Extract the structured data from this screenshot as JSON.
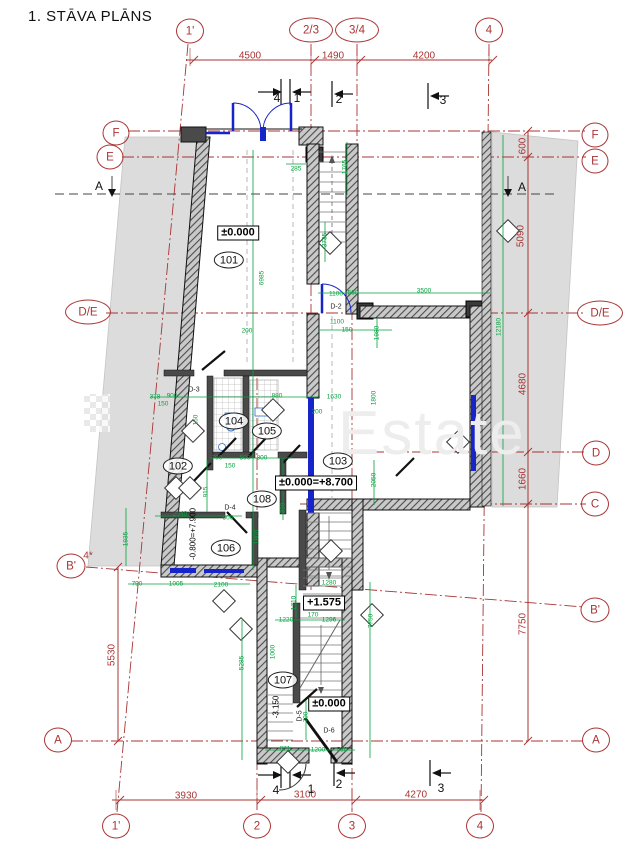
{
  "title": "1. STĀVA PLĀNS",
  "watermark": "Estate",
  "colors": {
    "axis_red": "#a93434",
    "dim_green": "#00a33c",
    "door_blue": "#1724c9",
    "wall_dark": "#4a4a4a",
    "neighbor_grey": "#dcdcdc"
  },
  "axis_markers": [
    {
      "label": "1'",
      "x": 190,
      "y": 31,
      "w": 26
    },
    {
      "label": "2/3",
      "x": 311,
      "y": 30,
      "w": 42
    },
    {
      "label": "3/4",
      "x": 357,
      "y": 30,
      "w": 42
    },
    {
      "label": "4",
      "x": 489,
      "y": 30,
      "w": 26
    },
    {
      "label": "1'",
      "x": 116,
      "y": 826,
      "w": 26
    },
    {
      "label": "2",
      "x": 257,
      "y": 826,
      "w": 26
    },
    {
      "label": "3",
      "x": 352,
      "y": 826,
      "w": 26
    },
    {
      "label": "4",
      "x": 480,
      "y": 826,
      "w": 26
    },
    {
      "label": "F",
      "x": 116,
      "y": 133,
      "w": 25
    },
    {
      "label": "E",
      "x": 110,
      "y": 157,
      "w": 25
    },
    {
      "label": "D/E",
      "x": 88,
      "y": 312,
      "w": 44
    },
    {
      "label": "B'",
      "x": 71,
      "y": 566,
      "w": 27
    },
    {
      "label": "A",
      "x": 58,
      "y": 740,
      "w": 26
    },
    {
      "label": "F",
      "x": 595,
      "y": 135,
      "w": 25
    },
    {
      "label": "E",
      "x": 595,
      "y": 161,
      "w": 25
    },
    {
      "label": "D/E",
      "x": 600,
      "y": 313,
      "w": 44
    },
    {
      "label": "D",
      "x": 596,
      "y": 453,
      "w": 26
    },
    {
      "label": "C",
      "x": 595,
      "y": 504,
      "w": 26
    },
    {
      "label": "B'",
      "x": 595,
      "y": 610,
      "w": 27
    },
    {
      "label": "A",
      "x": 596,
      "y": 740,
      "w": 26
    }
  ],
  "red_dims": [
    {
      "text": "4500",
      "x": 250,
      "y": 56
    },
    {
      "text": "1490",
      "x": 333,
      "y": 56
    },
    {
      "text": "4200",
      "x": 424,
      "y": 56
    },
    {
      "text": "3930",
      "x": 186,
      "y": 796
    },
    {
      "text": "3100",
      "x": 305,
      "y": 795
    },
    {
      "text": "4270",
      "x": 416,
      "y": 795
    },
    {
      "text": "600",
      "x": 523,
      "y": 146,
      "rot": 1
    },
    {
      "text": "5090",
      "x": 521,
      "y": 236,
      "rot": 1
    },
    {
      "text": "4680",
      "x": 523,
      "y": 384,
      "rot": 1
    },
    {
      "text": "1660",
      "x": 523,
      "y": 479,
      "rot": 1
    },
    {
      "text": "7750",
      "x": 523,
      "y": 624,
      "rot": 1
    },
    {
      "text": "5530",
      "x": 112,
      "y": 655,
      "rot": 1
    },
    {
      "text": "4*",
      "x": 88,
      "y": 556
    }
  ],
  "green_dims": [
    {
      "t": "6985",
      "x": 262,
      "y": 278,
      "r": 1
    },
    {
      "t": "3735",
      "x": 325,
      "y": 240,
      "r": 1
    },
    {
      "t": "1765",
      "x": 345,
      "y": 167,
      "r": 1
    },
    {
      "t": "285",
      "x": 296,
      "y": 169
    },
    {
      "t": "1100",
      "x": 336,
      "y": 294
    },
    {
      "t": "560",
      "x": 353,
      "y": 293
    },
    {
      "t": "3500",
      "x": 424,
      "y": 291
    },
    {
      "t": "1100",
      "x": 337,
      "y": 322
    },
    {
      "t": "150",
      "x": 347,
      "y": 330
    },
    {
      "t": "1980",
      "x": 377,
      "y": 333,
      "r": 1
    },
    {
      "t": "1630",
      "x": 334,
      "y": 397
    },
    {
      "t": "1800",
      "x": 374,
      "y": 398,
      "r": 1
    },
    {
      "t": "378",
      "x": 155,
      "y": 397
    },
    {
      "t": "900",
      "x": 172,
      "y": 396
    },
    {
      "t": "150",
      "x": 163,
      "y": 404
    },
    {
      "t": "880",
      "x": 277,
      "y": 396
    },
    {
      "t": "200",
      "x": 317,
      "y": 412
    },
    {
      "t": "150",
      "x": 196,
      "y": 420,
      "r": 1
    },
    {
      "t": "200",
      "x": 247,
      "y": 331
    },
    {
      "t": "700",
      "x": 217,
      "y": 458
    },
    {
      "t": "500",
      "x": 245,
      "y": 458
    },
    {
      "t": "800",
      "x": 262,
      "y": 458
    },
    {
      "t": "150",
      "x": 230,
      "y": 466
    },
    {
      "t": "915",
      "x": 206,
      "y": 492,
      "r": 1
    },
    {
      "t": "1090",
      "x": 281,
      "y": 482,
      "r": 1
    },
    {
      "t": "320",
      "x": 283,
      "y": 508,
      "r": 1
    },
    {
      "t": "2040",
      "x": 180,
      "y": 514
    },
    {
      "t": "800",
      "x": 228,
      "y": 518
    },
    {
      "t": "1935",
      "x": 126,
      "y": 539,
      "r": 1
    },
    {
      "t": "1800",
      "x": 257,
      "y": 537,
      "r": 1
    },
    {
      "t": "790",
      "x": 137,
      "y": 584
    },
    {
      "t": "1005",
      "x": 176,
      "y": 584
    },
    {
      "t": "2100",
      "x": 221,
      "y": 585
    },
    {
      "t": "2050",
      "x": 374,
      "y": 480,
      "r": 1
    },
    {
      "t": "1710",
      "x": 294,
      "y": 603,
      "r": 1
    },
    {
      "t": "170",
      "x": 313,
      "y": 615
    },
    {
      "t": "1296",
      "x": 329,
      "y": 620
    },
    {
      "t": "1220",
      "x": 286,
      "y": 620
    },
    {
      "t": "1280",
      "x": 329,
      "y": 583
    },
    {
      "t": "7750",
      "x": 371,
      "y": 621,
      "r": 1
    },
    {
      "t": "5285",
      "x": 242,
      "y": 663,
      "r": 1
    },
    {
      "t": "1000",
      "x": 273,
      "y": 652,
      "r": 1
    },
    {
      "t": "700",
      "x": 306,
      "y": 717,
      "r": 1
    },
    {
      "t": "871",
      "x": 285,
      "y": 749
    },
    {
      "t": "1200",
      "x": 318,
      "y": 750
    },
    {
      "t": "530",
      "x": 342,
      "y": 750
    },
    {
      "t": "12180",
      "x": 499,
      "y": 327,
      "r": 1
    }
  ],
  "rooms": [
    {
      "num": "101",
      "x": 229,
      "y": 260
    },
    {
      "num": "102",
      "x": 178,
      "y": 466
    },
    {
      "num": "103",
      "x": 338,
      "y": 461
    },
    {
      "num": "104",
      "x": 234,
      "y": 421
    },
    {
      "num": "105",
      "x": 267,
      "y": 431
    },
    {
      "num": "106",
      "x": 226,
      "y": 548
    },
    {
      "num": "107",
      "x": 283,
      "y": 680
    },
    {
      "num": "108",
      "x": 262,
      "y": 499
    }
  ],
  "elevations": [
    {
      "text": "±0.000",
      "x": 238,
      "y": 233
    },
    {
      "text": "±0.000=+8.700",
      "x": 316,
      "y": 483
    },
    {
      "text": "+1.575",
      "x": 324,
      "y": 603
    },
    {
      "text": "±0.000",
      "x": 329,
      "y": 704
    },
    {
      "text": "-0.800=+7.900",
      "x": 193,
      "y": 534,
      "rot": 1,
      "plain": 1
    },
    {
      "text": "-3.150",
      "x": 276,
      "y": 707,
      "rot": 1,
      "plain": 1
    }
  ],
  "door_labels": [
    {
      "text": "D-2",
      "x": 336,
      "y": 307
    },
    {
      "text": "D-3",
      "x": 194,
      "y": 390
    },
    {
      "text": "D-4",
      "x": 230,
      "y": 508
    },
    {
      "text": "D-5",
      "x": 300,
      "y": 716,
      "rot": 1
    },
    {
      "text": "D-6",
      "x": 329,
      "y": 731
    }
  ],
  "section_letters": [
    {
      "text": "A",
      "x": 99,
      "y": 186
    },
    {
      "text": "A",
      "x": 522,
      "y": 187
    }
  ],
  "section_numbers": [
    {
      "text": "4",
      "x": 277,
      "y": 98
    },
    {
      "text": "1",
      "x": 297,
      "y": 98
    },
    {
      "text": "2",
      "x": 339,
      "y": 99
    },
    {
      "text": "3",
      "x": 443,
      "y": 100
    },
    {
      "text": "4",
      "x": 276,
      "y": 790
    },
    {
      "text": "1",
      "x": 311,
      "y": 789
    },
    {
      "text": "2",
      "x": 339,
      "y": 784
    },
    {
      "text": "3",
      "x": 441,
      "y": 788
    }
  ]
}
